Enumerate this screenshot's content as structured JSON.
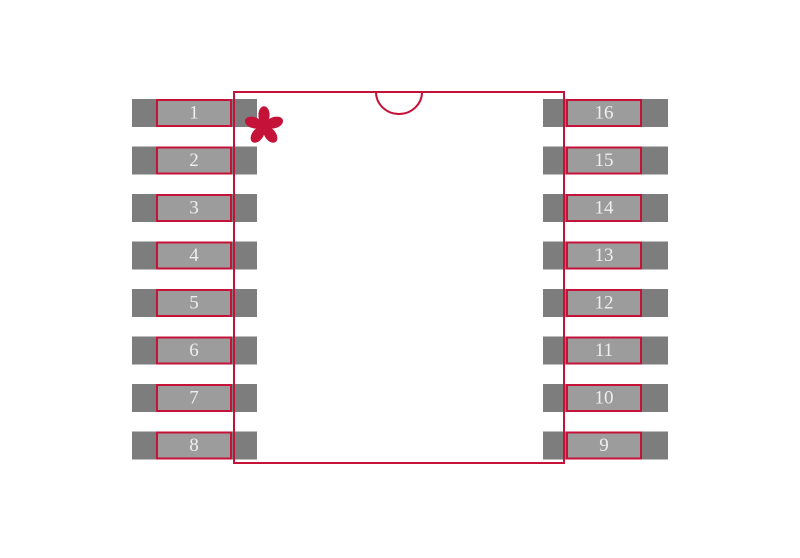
{
  "diagram": {
    "kind": "component-footprint",
    "pin_count": 16
  },
  "colors": {
    "outline_red": "#C41239",
    "pad_gray": "#7D7D7D",
    "pin_inner_gray": "#9C9C9C",
    "pin_number_text": "#EFEFEF",
    "background": "#FFFFFF"
  },
  "pins": {
    "left": [
      "1",
      "2",
      "3",
      "4",
      "5",
      "6",
      "7",
      "8"
    ],
    "right": [
      "16",
      "15",
      "14",
      "13",
      "12",
      "11",
      "10",
      "9"
    ]
  },
  "markers": {
    "pin1_indicator": "asterisk",
    "orientation_notch": "top-center-semicircle"
  }
}
